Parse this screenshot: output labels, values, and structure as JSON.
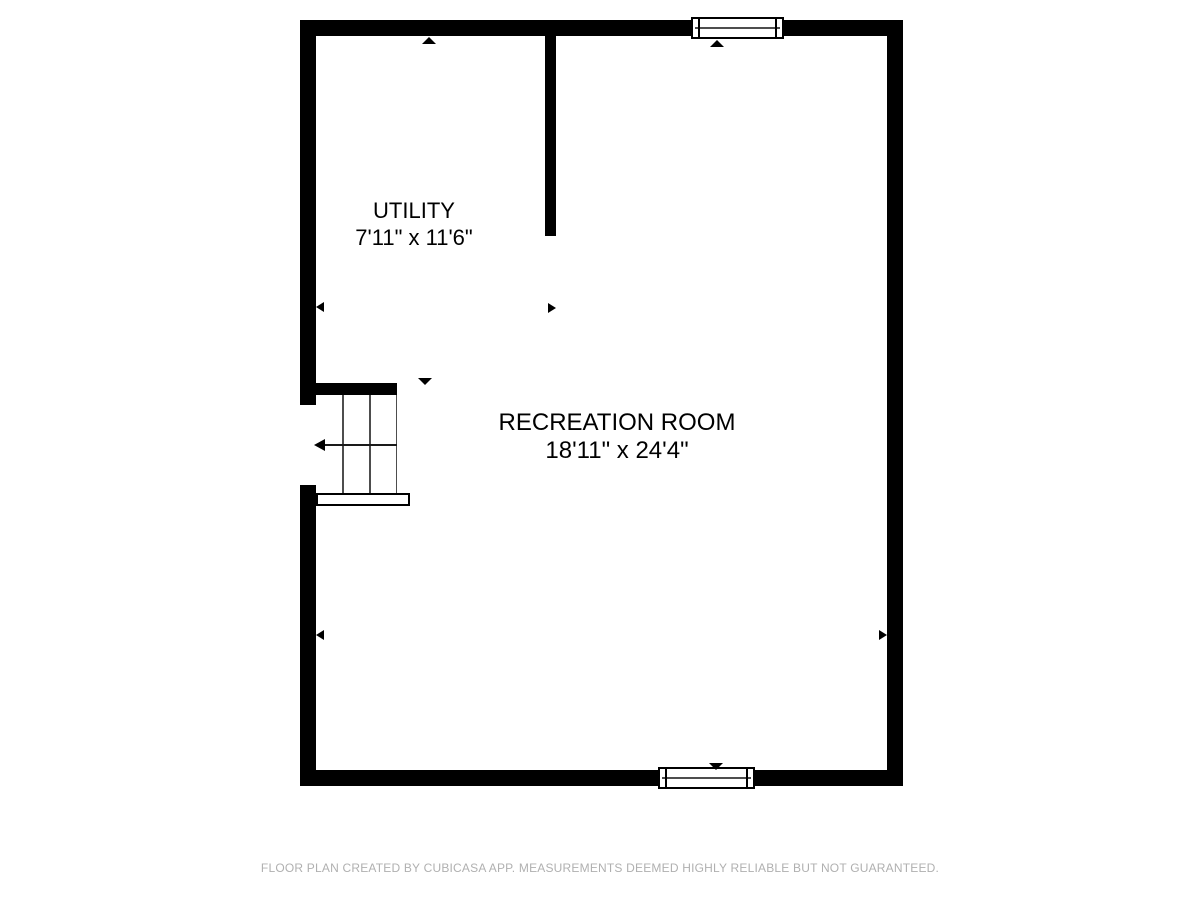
{
  "plan": {
    "rooms": [
      {
        "name": "UTILITY",
        "dimensions": "7'11\" x 11'6\""
      },
      {
        "name": "RECREATION ROOM",
        "dimensions": "18'11\" x 24'4\""
      }
    ],
    "features": {
      "windows": [
        "top-wall-window",
        "bottom-wall-window"
      ],
      "staircase": "left-side-staircase",
      "door_opening": "left-wall-opening"
    }
  },
  "footer": {
    "disclaimer": "FLOOR PLAN CREATED BY CUBICASA APP. MEASUREMENTS DEEMED HIGHLY RELIABLE BUT NOT GUARANTEED."
  },
  "colors": {
    "wall": "#000000",
    "background": "#ffffff",
    "footer_text": "#b0b0b0",
    "detail_line": "#4d4d4d"
  }
}
